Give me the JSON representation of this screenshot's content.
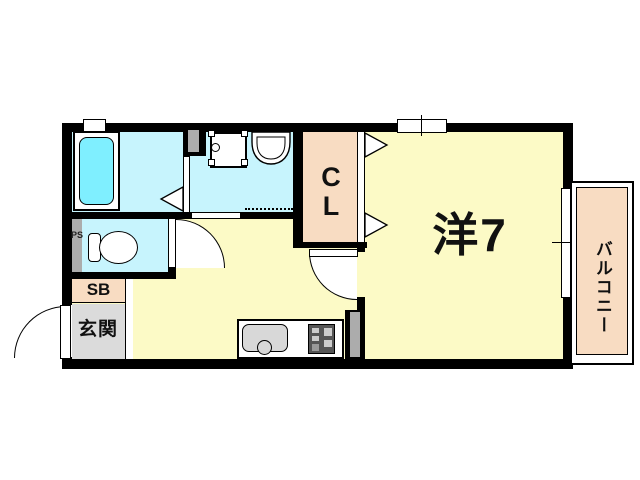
{
  "floorplan": {
    "title": "1K apartment floor plan",
    "rooms": {
      "western_room": {
        "label": "洋7"
      },
      "closet": {
        "label": "CL"
      },
      "balcony": {
        "label": "バルコニー"
      },
      "entrance": {
        "label": "玄関"
      },
      "shoe_box": {
        "label": "SB"
      },
      "pipe_space": {
        "label": "PS"
      }
    },
    "fixtures": [
      "bathtub-icon",
      "washing-machine-icon",
      "wash-basin-icon",
      "toilet-icon",
      "kitchen-sink-icon",
      "gas-stove-icon",
      "folding-door-icon",
      "swing-door-icon",
      "sliding-window-icon"
    ],
    "colors": {
      "room_yellow": "#FCFAC6",
      "wet_cyan": "#C7F4FD",
      "tub_cyan": "#7FEFFF",
      "closet_peach": "#F8DCC2",
      "entrance_gray": "#DBDBDB",
      "duct_gray": "#ACACAC",
      "wall_black": "#000000"
    }
  }
}
